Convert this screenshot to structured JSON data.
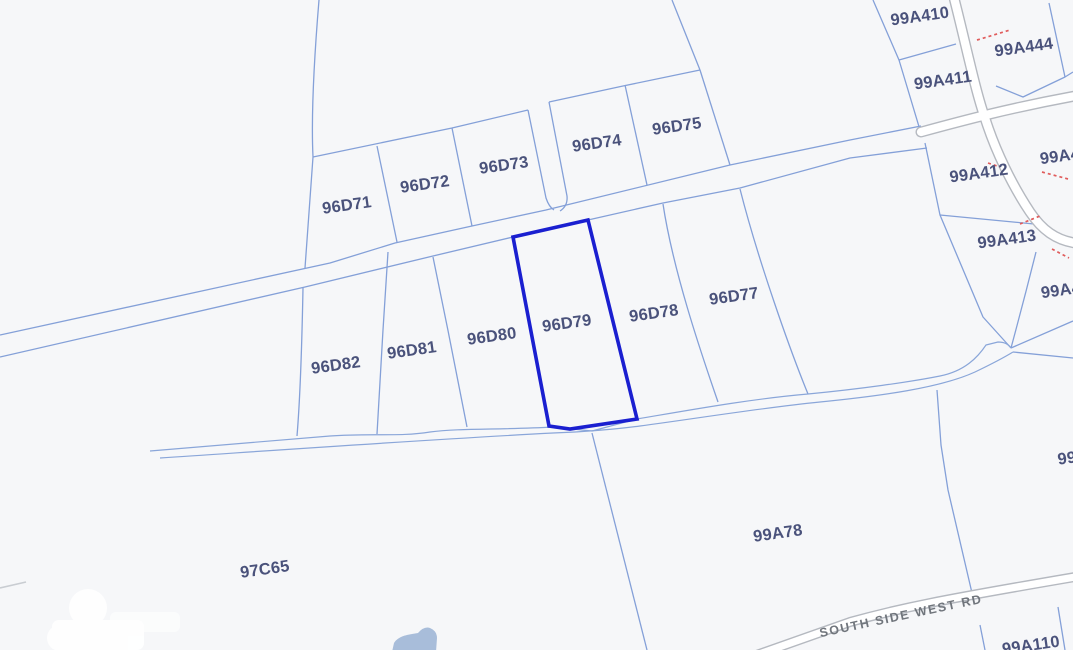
{
  "map": {
    "selected_parcel": "96D79",
    "road_name": "SOUTH SIDE WEST RD",
    "colors": {
      "background": "#f6f7f9",
      "boundary": "#84a0d8",
      "stream": "#8aa6d9",
      "highlight": "#1a1fd0",
      "road_casing": "#b5b9c0",
      "road_fill": "#ffffff",
      "annotation": "#e05c5c",
      "water": "#a8bdda",
      "label": "#4a527b",
      "road_label": "#70757c",
      "fragment": "#c9cdd2"
    },
    "parcel_labels": [
      {
        "id": "96D71",
        "x": 347,
        "y": 206
      },
      {
        "id": "96D72",
        "x": 425,
        "y": 185
      },
      {
        "id": "96D73",
        "x": 504,
        "y": 166
      },
      {
        "id": "96D74",
        "x": 597,
        "y": 144
      },
      {
        "id": "96D75",
        "x": 677,
        "y": 127
      },
      {
        "id": "96D82",
        "x": 336,
        "y": 366
      },
      {
        "id": "96D81",
        "x": 412,
        "y": 351
      },
      {
        "id": "96D80",
        "x": 492,
        "y": 337
      },
      {
        "id": "96D79",
        "x": 567,
        "y": 324
      },
      {
        "id": "96D78",
        "x": 654,
        "y": 314
      },
      {
        "id": "96D77",
        "x": 734,
        "y": 297
      },
      {
        "id": "99A410",
        "x": 920,
        "y": 17
      },
      {
        "id": "99A444",
        "x": 1024,
        "y": 48
      },
      {
        "id": "99A411",
        "x": 943,
        "y": 81
      },
      {
        "id": "99A412",
        "x": 979,
        "y": 174
      },
      {
        "id": "99A413",
        "x": 1007,
        "y": 240
      },
      {
        "id": "99A4",
        "x": 1060,
        "y": 157
      },
      {
        "id": "99A4",
        "x": 1061,
        "y": 291
      },
      {
        "id": "99",
        "x": 1067,
        "y": 459
      },
      {
        "id": "99A78",
        "x": 778,
        "y": 534
      },
      {
        "id": "97C65",
        "x": 265,
        "y": 570
      },
      {
        "id": "99A110",
        "x": 1031,
        "y": 646
      }
    ]
  }
}
